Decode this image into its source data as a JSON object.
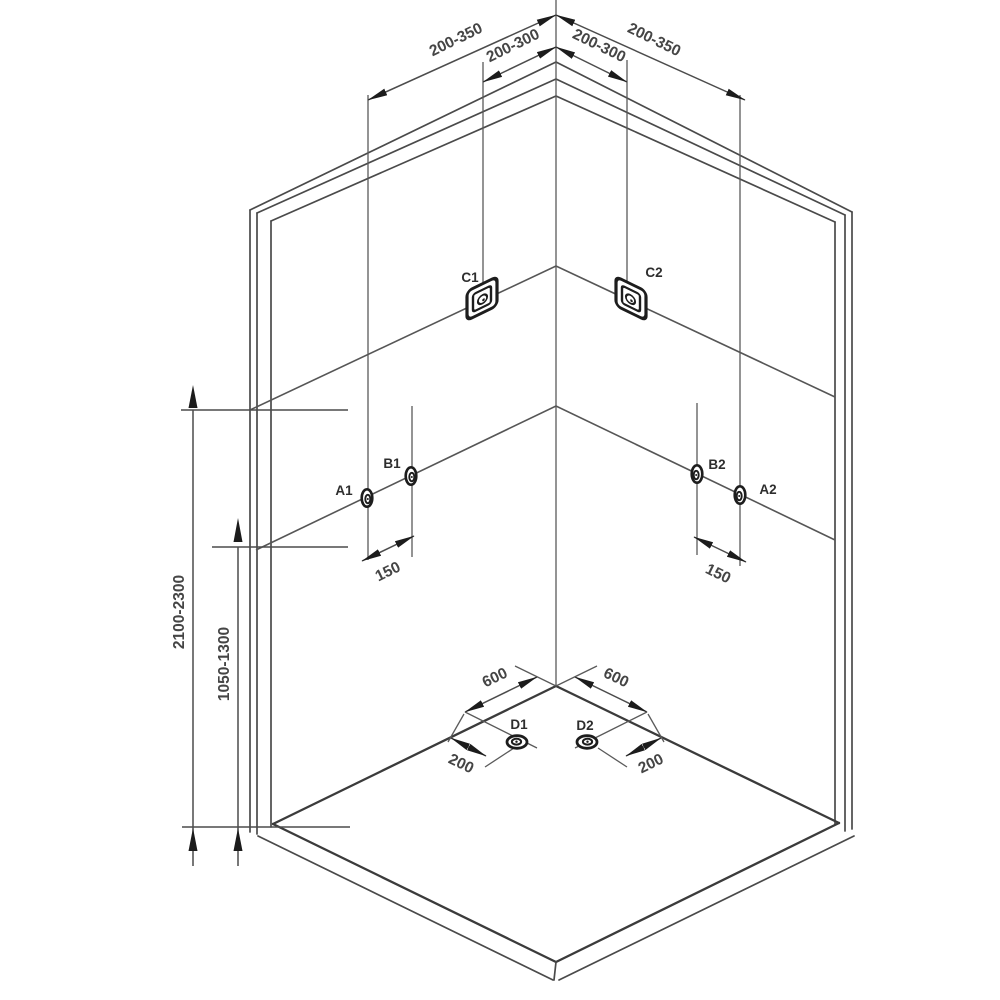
{
  "diagram": {
    "type": "installation-diagram",
    "subject": "corner shower enclosure fixture mounting positions"
  },
  "dims": {
    "top_left_outer": "200-350",
    "top_left_inner": "200-300",
    "top_right_inner": "200-300",
    "top_right_outer": "200-350",
    "height_upper": "2100-2300",
    "height_mid": "1050-1300",
    "spacing_left": "150",
    "spacing_right": "150",
    "floor_left": "600",
    "floor_right": "600",
    "offset_left": "200",
    "offset_right": "200"
  },
  "fixtures": {
    "c1": "C1",
    "c2": "C2",
    "a1": "A1",
    "b1": "B1",
    "b2": "B2",
    "a2": "A2",
    "d1": "D1",
    "d2": "D2"
  },
  "colors": {
    "line": "#4a4a4a",
    "text": "#454545",
    "arrow": "#1c1c1c",
    "background": "#ffffff"
  }
}
